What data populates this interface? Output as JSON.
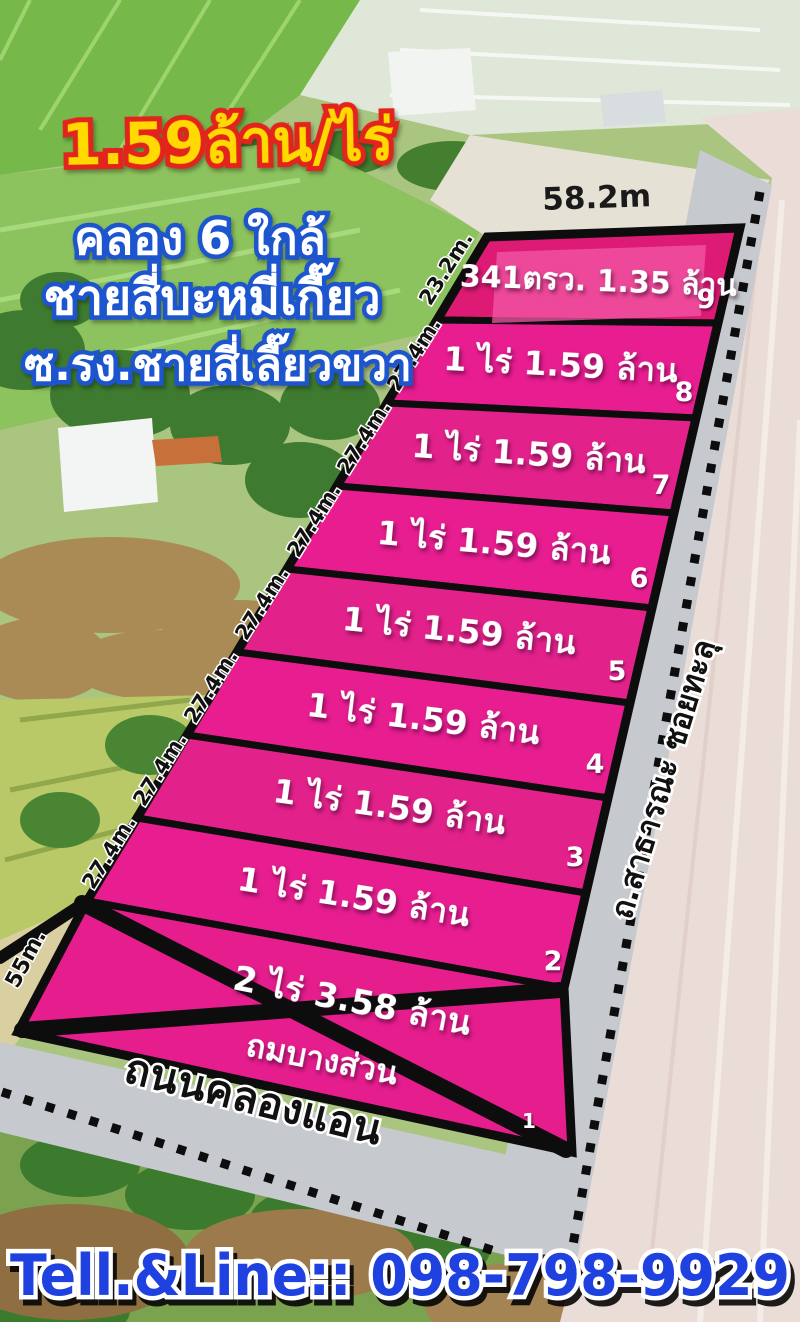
{
  "listing": {
    "price_headline": "1.59ล้าน/ไร่",
    "location_line1": "คลอง 6 ใกล้",
    "location_line2": "ชายสี่บะหมี่เกี๊ยว",
    "location_line3": "ซ.รง.ชายสี่เลี๊ยวขวา"
  },
  "dimensions": {
    "top_width": "58.2m",
    "plot9_left_side": "23.2m.",
    "side_labels": [
      "27.4m.",
      "27.4m.",
      "27.4m.",
      "27.4m.",
      "27.4m.",
      "27.4m.",
      "27.4m."
    ],
    "bottom_left_side": "55m."
  },
  "plots": [
    {
      "number": "9",
      "label": "341ตรว. 1.35 ล้าน"
    },
    {
      "number": "8",
      "label": "1 ไร่ 1.59 ล้าน"
    },
    {
      "number": "7",
      "label": "1 ไร่ 1.59 ล้าน"
    },
    {
      "number": "6",
      "label": "1 ไร่ 1.59 ล้าน"
    },
    {
      "number": "5",
      "label": "1 ไร่ 1.59 ล้าน"
    },
    {
      "number": "4",
      "label": "1 ไร่ 1.59 ล้าน"
    },
    {
      "number": "3",
      "label": "1 ไร่ 1.59 ล้าน"
    },
    {
      "number": "2",
      "label": "1 ไร่ 1.59 ล้าน"
    },
    {
      "number": "1",
      "label": "2 ไร่ 3.58 ล้าน",
      "label2": "ถมบางส่วน",
      "status": "crossed-out"
    }
  ],
  "roads": {
    "bottom_road": "ถนนคลองแอน",
    "right_road": "ถ.สาธารณะ ซอยทะลุ"
  },
  "contact": {
    "phone_line": "Tell.&Line:: 098-798-9929"
  },
  "colors": {
    "plot_pink": "#e71d90",
    "plot9_crimson": "#dd1a74",
    "headline_yellow": "#ffd900",
    "headline_outline": "#e3241d",
    "location_outline": "#1d55cf",
    "phone_blue": "#1f41e0",
    "road_gray": "#c6c9ce"
  }
}
